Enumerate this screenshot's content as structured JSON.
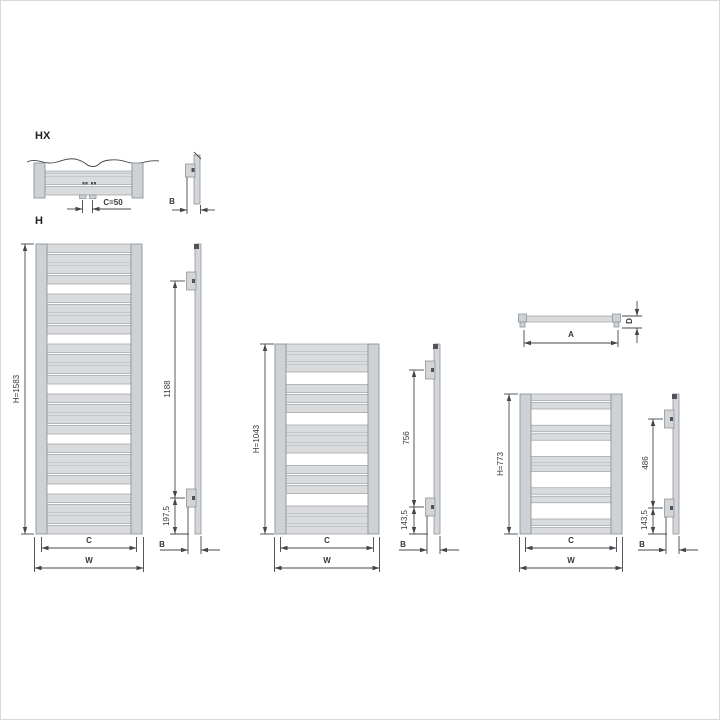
{
  "page": {
    "background": "#ffffff",
    "border_color": "#d9d9d9"
  },
  "palette": {
    "line": "#43474b",
    "bar_fill": "#d9dbdd",
    "bar_stroke": "#a3a8ac",
    "tube_fill": "#cfd2d5",
    "tube_stroke": "#8f959a",
    "side_fill": "#d4d7d9",
    "bracket_fill": "#d3d5d7",
    "dark_detail": "#505458",
    "text": "#34383c"
  },
  "sections": {
    "hx_detail": {
      "title": "HX",
      "pipe_spacing_label": "C=50",
      "depth_label": "B"
    },
    "h_series": {
      "title": "H"
    },
    "top_view": {
      "width_label": "A",
      "depth_label": "D"
    },
    "radiators": [
      {
        "height_label": "H=1583",
        "bracket_span_label": "1188",
        "bracket_bottom_offset_label": "197,5",
        "connection_width_label": "C",
        "overall_width_label": "W",
        "depth_label": "B"
      },
      {
        "height_label": "H=1043",
        "bracket_span_label": "756",
        "bracket_bottom_offset_label": "143,5",
        "connection_width_label": "C",
        "overall_width_label": "W",
        "depth_label": "B"
      },
      {
        "height_label": "H=773",
        "bracket_span_label": "486",
        "bracket_bottom_offset_label": "143,5",
        "connection_width_label": "C",
        "overall_width_label": "W",
        "depth_label": "B"
      }
    ]
  }
}
